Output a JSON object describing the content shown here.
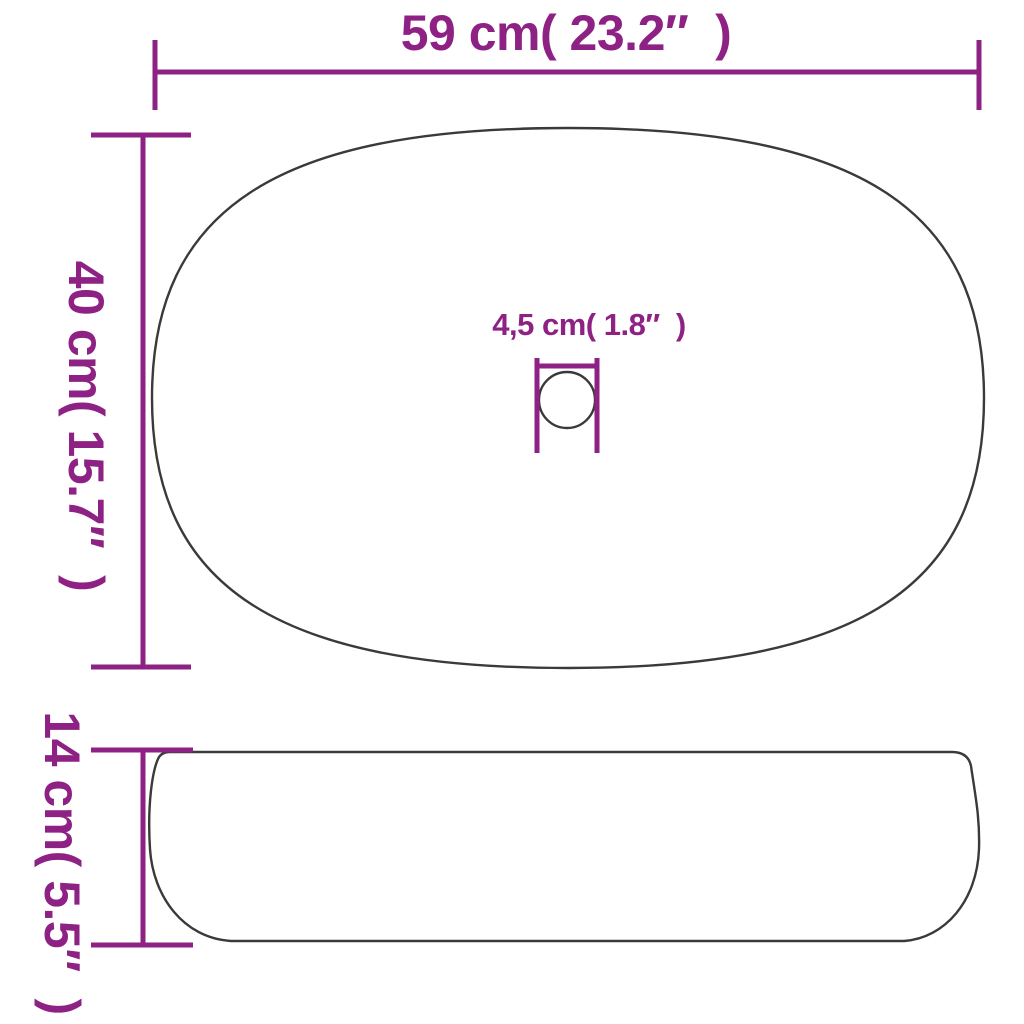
{
  "diagram": {
    "type": "product-dimension-drawing",
    "subject": "oval countertop wash basin, top view and side view",
    "colors": {
      "dimension": "#8e2184",
      "outline": "#3a3a3a",
      "background": "#ffffff"
    },
    "dimensions": {
      "width_label": "59 cm( 23.2″  )",
      "depth_label": "40 cm( 15.7″  )",
      "drain_label": "4,5 cm( 1.8″  )",
      "height_label": "14 cm( 5.5″  )"
    }
  }
}
